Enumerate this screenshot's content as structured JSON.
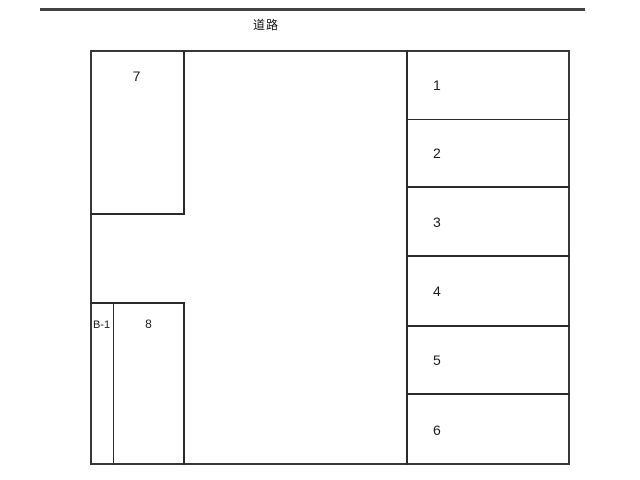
{
  "road": {
    "label": "道路"
  },
  "lot": {
    "space7": {
      "label": "7"
    },
    "space8": {
      "label": "8"
    },
    "bike_space": {
      "label": "B-1"
    },
    "right_spaces": [
      {
        "label": "1"
      },
      {
        "label": "2"
      },
      {
        "label": "3"
      },
      {
        "label": "4"
      },
      {
        "label": "5"
      },
      {
        "label": "6"
      }
    ]
  },
  "colors": {
    "background": "#ffffff",
    "boundary_line": "#383838",
    "inner_line": "#2b2b2b",
    "road_line": "#424242"
  }
}
